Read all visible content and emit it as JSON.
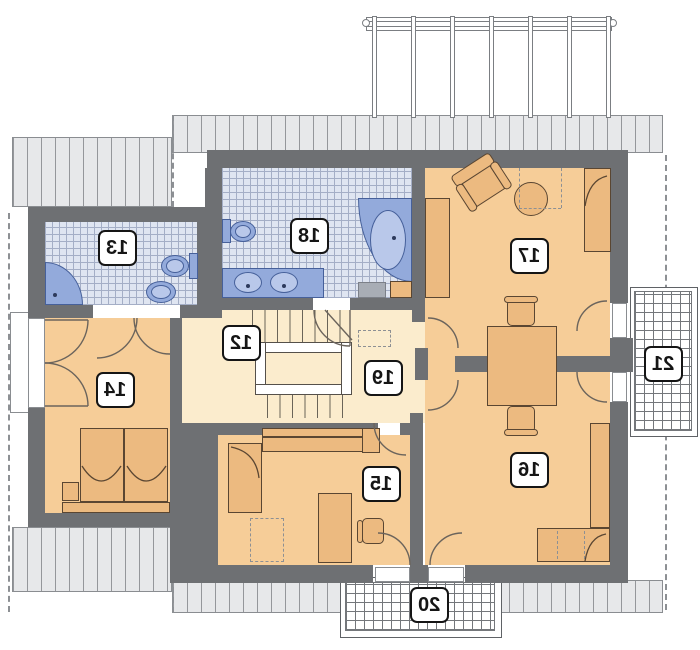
{
  "rooms": [
    {
      "label": "12"
    },
    {
      "label": "13"
    },
    {
      "label": "14"
    },
    {
      "label": "15"
    },
    {
      "label": "16"
    },
    {
      "label": "17"
    },
    {
      "label": "18"
    },
    {
      "label": "19"
    },
    {
      "label": "20"
    },
    {
      "label": "21"
    }
  ],
  "colors": {
    "wall": "#6e7073",
    "bedroom_floor": "#f6cd98",
    "hall_floor": "#fbeccd",
    "furniture": "#ecba80",
    "furniture_outline": "#5a4632",
    "tile_floor": "#dfe5f1",
    "tile_line": "#a4aec6",
    "sanitary_fixture": "#93aadb",
    "roof_band": "#e7e8ea",
    "roof_hatch_line": "#95979b",
    "balcony_grid_line": "#74777b",
    "label_plate_bg": "#ffffff",
    "label_plate_border": "#151515"
  }
}
